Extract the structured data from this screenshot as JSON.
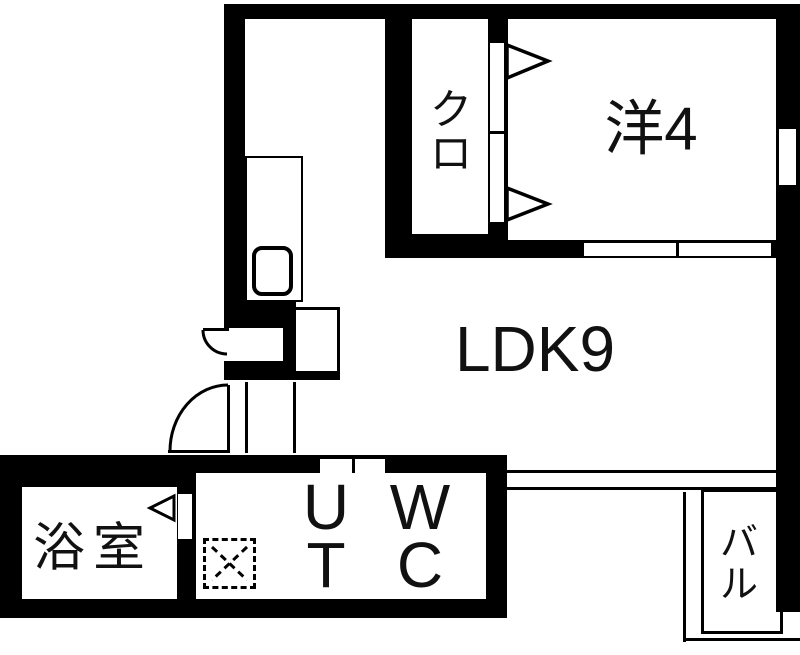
{
  "plan": {
    "background_color": "#ffffff",
    "wall_color": "#000000",
    "rooms": {
      "closet": {
        "label": "クロ",
        "chars": [
          "ク",
          "ロ"
        ]
      },
      "western_room": {
        "label": "洋4"
      },
      "ldk": {
        "label": "LDK9"
      },
      "bathroom": {
        "label": "浴室"
      },
      "utility": {
        "label": "UT",
        "lines": [
          "U",
          "T"
        ]
      },
      "toilet": {
        "label": "WC",
        "lines": [
          "W",
          "C"
        ]
      },
      "balcony": {
        "label": "バル",
        "chars": [
          "バ",
          "ル"
        ]
      }
    },
    "fixture_icons": [
      "kitchen-counter",
      "kitchen-sink",
      "refrigerator-space",
      "washing-machine-space",
      "entry-door-swing",
      "service-door-swing",
      "bathroom-door",
      "closet-door-panels",
      "closet-door-swing-arrows",
      "sliding-door",
      "sliding-window",
      "wall-window",
      "balcony-rail"
    ]
  }
}
